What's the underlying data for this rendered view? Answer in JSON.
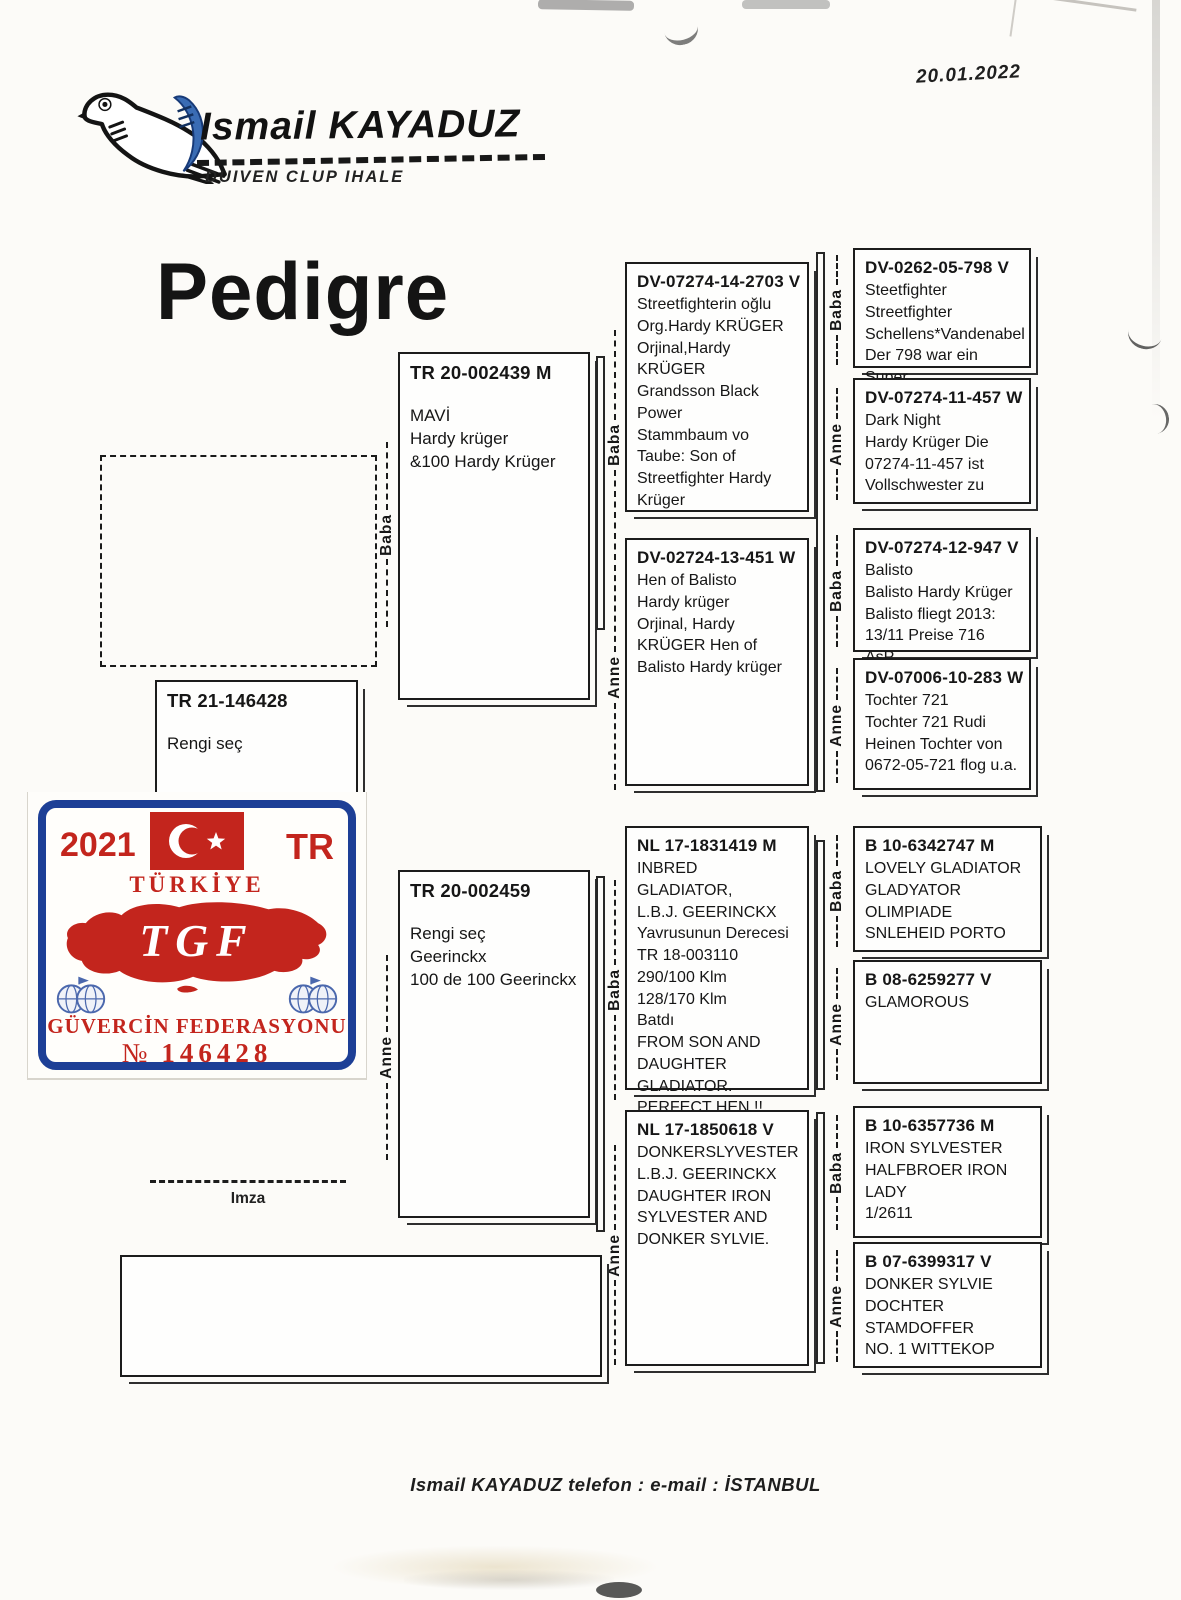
{
  "page": {
    "date": "20.01.2022",
    "title": "Pedigre",
    "imza_label": "Imza",
    "footer": "Ismail KAYADUZ  telefon :   e-mail : İSTANBUL"
  },
  "header": {
    "name": "Ismail KAYADUZ",
    "subtitle": "DUIVEN CLUP IHALE"
  },
  "labels": {
    "father": "Baba",
    "mother": "Anne"
  },
  "sticker": {
    "year": "2021",
    "country_code": "TR",
    "country": "TÜRKİYE",
    "org_abbr": "TGF",
    "org_name": "GÜVERCİN FEDERASYONU",
    "number_sign": "№",
    "number": "146428",
    "colors": {
      "red": "#c3251d",
      "blue": "#1d3f96"
    }
  },
  "subject": {
    "ring": "TR 21-146428",
    "lines": [
      "Rengi seç"
    ]
  },
  "tree": {
    "father": {
      "ring": "TR 20-002439 M",
      "lines": [
        "MAVİ",
        "Hardy krüger",
        "&100 Hardy Krüger"
      ]
    },
    "mother": {
      "ring": "TR 20-002459",
      "lines": [
        "Rengi seç",
        "Geerinckx",
        "100 de 100 Geerinckx"
      ]
    },
    "ff": {
      "ring": "DV-07274-14-2703 V",
      "lines": [
        "Streetfighterin oğlu",
        "Org.Hardy KRÜGER",
        "Orjinal,Hardy KRÜGER",
        "Grandsson Black",
        "Power",
        "Stammbaum vo",
        "Taube: Son of",
        "Streetfighter Hardy",
        "Krüger"
      ]
    },
    "fm": {
      "ring": "DV-02724-13-451 W",
      "lines": [
        "Hen of Balisto",
        "Hardy krüger",
        "Orjinal, Hardy",
        "KRÜGER Hen of",
        "Balisto Hardy krüger"
      ]
    },
    "mf": {
      "ring": "NL 17-1831419 M",
      "lines": [
        "INBRED GLADIATOR,",
        "L.B.J. GEERINCKX",
        "Yavrusunun Derecesi",
        "TR 18-003110",
        "290/100 Klm",
        "128/170 Klm",
        "Batdı",
        "FROM SON AND",
        "DAUGHTER",
        "GLADIATOR.",
        "PERFECT HEN !!"
      ]
    },
    "mm": {
      "ring": "NL 17-1850618 V",
      "lines": [
        "DONKERSLYVESTER",
        "L.B.J. GEERINCKX",
        "DAUGHTER IRON",
        "SYLVESTER AND",
        "DONKER SYLVIE."
      ]
    },
    "fff": {
      "ring": "DV-0262-05-798 V",
      "lines": [
        "Steetfighter",
        "Streetfighter",
        "Schellens*Vandenabel",
        "Der 798 war ein Super"
      ]
    },
    "ffm": {
      "ring": "DV-07274-11-457 W",
      "lines": [
        "Dark Night",
        "Hardy Krüger Die",
        "07274-11-457 ist",
        "Vollschwester zu"
      ]
    },
    "fmf": {
      "ring": "DV-07274-12-947 V",
      "lines": [
        "Balisto",
        "Balisto Hardy Krüger",
        "Balisto fliegt 2013:",
        "13/11 Preise 716 AsP."
      ]
    },
    "fmm": {
      "ring": "DV-07006-10-283 W",
      "lines": [
        "Tochter 721",
        "Tochter 721 Rudi",
        "Heinen Tochter von",
        "0672-05-721 flog u.a."
      ]
    },
    "mff": {
      "ring": "B 10-6342747 M",
      "lines": [
        "LOVELY GLADIATOR",
        "GLADYATOR",
        "OLIMPIADE",
        "SNLEHEID PORTO"
      ]
    },
    "mfm": {
      "ring": "B 08-6259277 V",
      "lines": [
        "GLAMOROUS"
      ]
    },
    "mmf": {
      "ring": "B 10-6357736 M",
      "lines": [
        "IRON SYLVESTER",
        "HALFBROER IRON",
        "LADY",
        "1/2611"
      ]
    },
    "mmm": {
      "ring": "B 07-6399317 V",
      "lines": [
        "DONKER SYLVIE",
        "DOCHTER",
        "STAMDOFFER",
        "NO. 1  WITTEKOP"
      ]
    }
  }
}
